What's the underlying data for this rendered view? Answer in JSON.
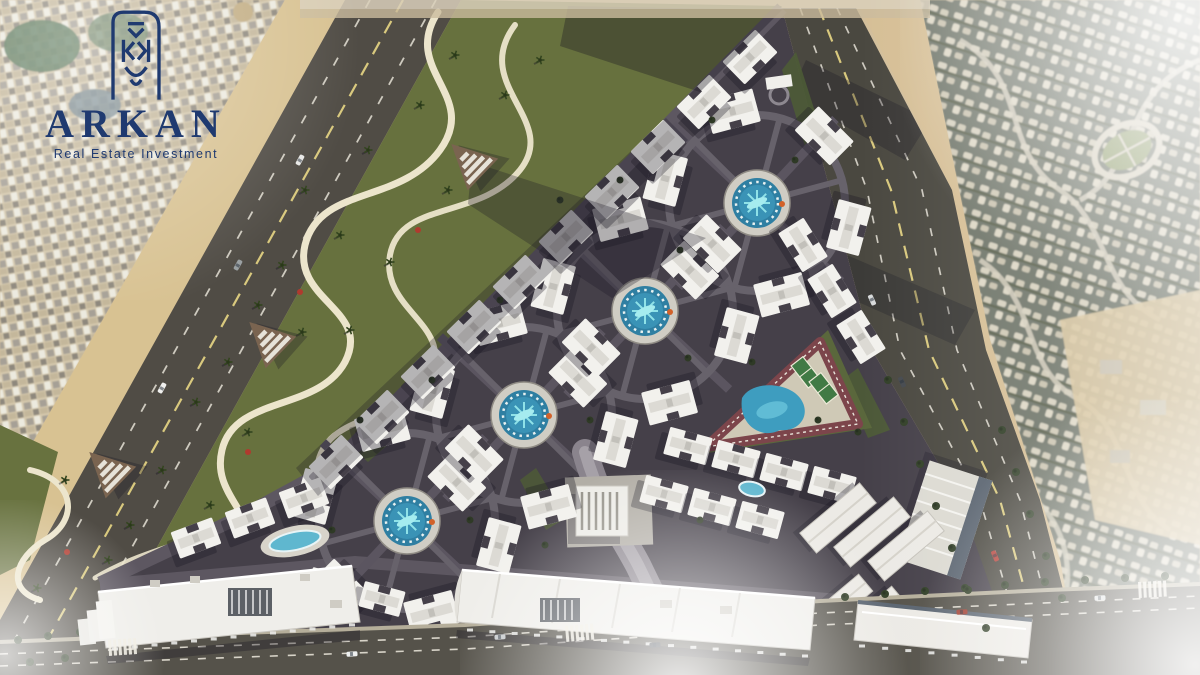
{
  "brand": {
    "name": "ARKAN",
    "tagline": "Real Estate Investment",
    "logo_color": "#1f3a70",
    "logo_mark": "arch-chevron-monogram-icon"
  },
  "scene": {
    "description": "Aerial 3D master-plan render of a triangular residential compound with circular pool plazas, central sports club, commercial strips and perimeter roads, composited over desert satellite imagery",
    "palette": {
      "sand": "#d3bf9b",
      "city_bg": "#d6c9ad",
      "road_asphalt": "#504c45",
      "avenue_asphalt": "#4a4840",
      "lane_yellow": "#d9c97e",
      "lane_white": "#eeeade",
      "park_green": "#67713e",
      "path_cream": "#ece5cc",
      "site_asphalt": "#454049",
      "street_line": "#5d5761",
      "building_white": "#f2f1ed",
      "roof_gray": "#dcdad4",
      "pool_blue": "#2f7fa2",
      "pool_glow": "#8fe2e8",
      "plaza_deck": "#d0cdc4",
      "suburb_bg": "#70766a",
      "suburb_block": "#d7d1bf",
      "track_maroon": "#7c454b",
      "court_green": "#417a45",
      "navy": "#1f3a70",
      "shadow": "rgba(25,22,35,0.32)"
    },
    "residential_clusters": [
      {
        "cx": 757,
        "cy": 203
      },
      {
        "cx": 645,
        "cy": 311
      },
      {
        "cx": 524,
        "cy": 415
      },
      {
        "cx": 407,
        "cy": 521
      }
    ],
    "building_rows": [
      {
        "x": 336,
        "y": 462,
        "dx": 46,
        "dy": -45,
        "count": 10,
        "w": 46,
        "h": 32
      },
      {
        "x": 803,
        "y": 245,
        "dx": 29,
        "dy": 46,
        "count": 3,
        "w": 46,
        "h": 30
      },
      {
        "x": 688,
        "y": 446,
        "dx": 48,
        "dy": 13,
        "count": 4,
        "w": 44,
        "h": 28
      },
      {
        "x": 664,
        "y": 494,
        "dx": 48,
        "dy": 13,
        "count": 3,
        "w": 44,
        "h": 28
      },
      {
        "x": 196,
        "y": 538,
        "dx": 54,
        "dy": -20,
        "count": 3,
        "w": 44,
        "h": 28
      },
      {
        "x": 330,
        "y": 585,
        "dx": 52,
        "dy": 14,
        "count": 2,
        "w": 42,
        "h": 26
      }
    ],
    "entrance_gates": [
      {
        "x": 470,
        "y": 162,
        "rot": -46
      },
      {
        "x": 268,
        "y": 340,
        "rot": -46
      },
      {
        "x": 108,
        "y": 470,
        "rot": -46
      }
    ],
    "extra_pools": [
      {
        "cx": 295,
        "cy": 541,
        "rx": 26,
        "ry": 9,
        "rot": -12,
        "deck": true
      },
      {
        "cx": 752,
        "cy": 489,
        "rx": 13,
        "ry": 7,
        "rot": 12,
        "deck": false
      }
    ],
    "intersection_islands": [
      [
        701,
        257
      ],
      [
        585,
        362
      ],
      [
        466,
        467
      ]
    ],
    "park_palms": [
      [
        455,
        55
      ],
      [
        420,
        105
      ],
      [
        368,
        150
      ],
      [
        448,
        190
      ],
      [
        305,
        190
      ],
      [
        340,
        235
      ],
      [
        282,
        265
      ],
      [
        390,
        262
      ],
      [
        258,
        305
      ],
      [
        302,
        332
      ],
      [
        350,
        330
      ],
      [
        228,
        362
      ],
      [
        196,
        402
      ],
      [
        248,
        432
      ],
      [
        162,
        470
      ],
      [
        210,
        505
      ],
      [
        130,
        525
      ],
      [
        108,
        560
      ],
      [
        37,
        588
      ],
      [
        65,
        480
      ],
      [
        505,
        95
      ],
      [
        540,
        60
      ]
    ],
    "flower_shrubs": [
      [
        300,
        292
      ],
      [
        248,
        452
      ],
      [
        67,
        552
      ],
      [
        418,
        230
      ]
    ],
    "site_trees": [
      [
        712,
        120
      ],
      [
        795,
        160
      ],
      [
        560,
        200
      ],
      [
        688,
        358
      ],
      [
        752,
        362
      ],
      [
        818,
        420
      ],
      [
        500,
        300
      ],
      [
        432,
        380
      ],
      [
        590,
        420
      ],
      [
        360,
        420
      ],
      [
        332,
        530
      ],
      [
        470,
        520
      ],
      [
        545,
        545
      ],
      [
        700,
        520
      ],
      [
        858,
        432
      ],
      [
        620,
        180
      ],
      [
        680,
        250
      ]
    ],
    "avenue_trees": [
      [
        888,
        380
      ],
      [
        904,
        422
      ],
      [
        920,
        464
      ],
      [
        936,
        506
      ],
      [
        952,
        548
      ],
      [
        968,
        590
      ],
      [
        986,
        628
      ],
      [
        1002,
        430
      ],
      [
        1016,
        472
      ],
      [
        1030,
        514
      ],
      [
        1046,
        556
      ],
      [
        1062,
        598
      ]
    ],
    "boulevard_trees": [
      [
        18,
        640
      ],
      [
        48,
        636
      ],
      [
        80,
        632
      ],
      [
        115,
        629
      ],
      [
        148,
        626
      ],
      [
        30,
        662
      ],
      [
        65,
        658
      ],
      [
        845,
        597
      ],
      [
        885,
        594
      ],
      [
        925,
        591
      ],
      [
        965,
        588
      ],
      [
        1005,
        585
      ],
      [
        1045,
        582
      ],
      [
        1085,
        580
      ],
      [
        1125,
        578
      ],
      [
        1165,
        576
      ]
    ],
    "crosswalks": [
      {
        "x": 108,
        "y": 640,
        "rot": -4
      },
      {
        "x": 565,
        "y": 626,
        "rot": -5
      },
      {
        "x": 1138,
        "y": 582,
        "rot": -3
      }
    ],
    "vehicles": [
      {
        "x": 352,
        "y": 654,
        "rot": -4,
        "color": "#eef0f0"
      },
      {
        "x": 500,
        "y": 637,
        "rot": -4,
        "color": "#c8cbcd"
      },
      {
        "x": 655,
        "y": 645,
        "rot": -4,
        "color": "#3a3f45"
      },
      {
        "x": 962,
        "y": 612,
        "rot": -4,
        "color": "#a13f32"
      },
      {
        "x": 1100,
        "y": 598,
        "rot": -4,
        "color": "#dde0e0"
      },
      {
        "x": 300,
        "y": 160,
        "rot": -61,
        "color": "#e8e8e6"
      },
      {
        "x": 238,
        "y": 265,
        "rot": -61,
        "color": "#9aa0a2"
      },
      {
        "x": 162,
        "y": 388,
        "rot": -61,
        "color": "#f0f0ee"
      },
      {
        "x": 872,
        "y": 300,
        "rot": 66,
        "color": "#d8dadb"
      },
      {
        "x": 902,
        "y": 382,
        "rot": 66,
        "color": "#45494e"
      },
      {
        "x": 995,
        "y": 556,
        "rot": 67,
        "color": "#b5423a"
      }
    ]
  }
}
